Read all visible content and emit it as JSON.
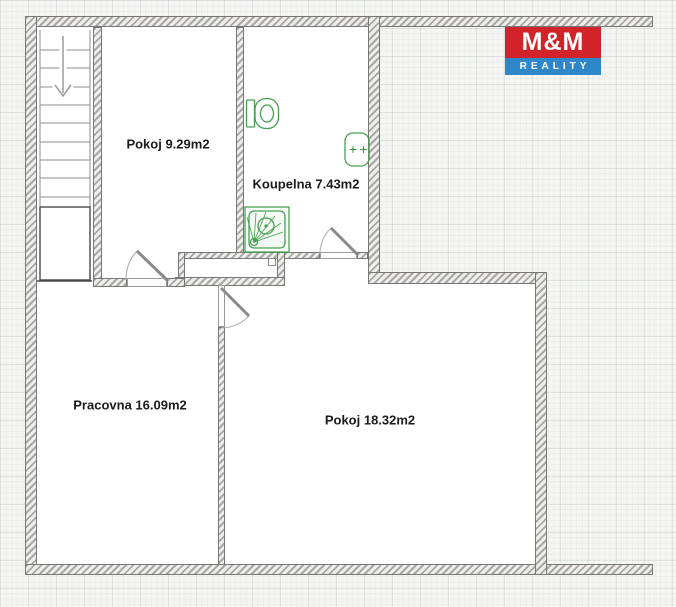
{
  "rooms": [
    {
      "id": "pokoj-small",
      "label": "Pokoj 9.29m2"
    },
    {
      "id": "koupelna",
      "label": "Koupelna 7.43m2"
    },
    {
      "id": "pracovna",
      "label": "Pracovna 16.09m2"
    },
    {
      "id": "pokoj-large",
      "label": "Pokoj 18.32m2"
    }
  ],
  "logo": {
    "line1": "M&M",
    "line2": "REALITY"
  },
  "stairs": {
    "direction": "down",
    "steps": 10
  },
  "fixtures": [
    "toilet",
    "sink",
    "shower"
  ],
  "colors": {
    "fixture_green": "#44a04e",
    "logo_red": "#d2232a",
    "logo_blue": "#2d87c8",
    "wall_outline": "#777777",
    "label_text": "#1b1b1b"
  }
}
